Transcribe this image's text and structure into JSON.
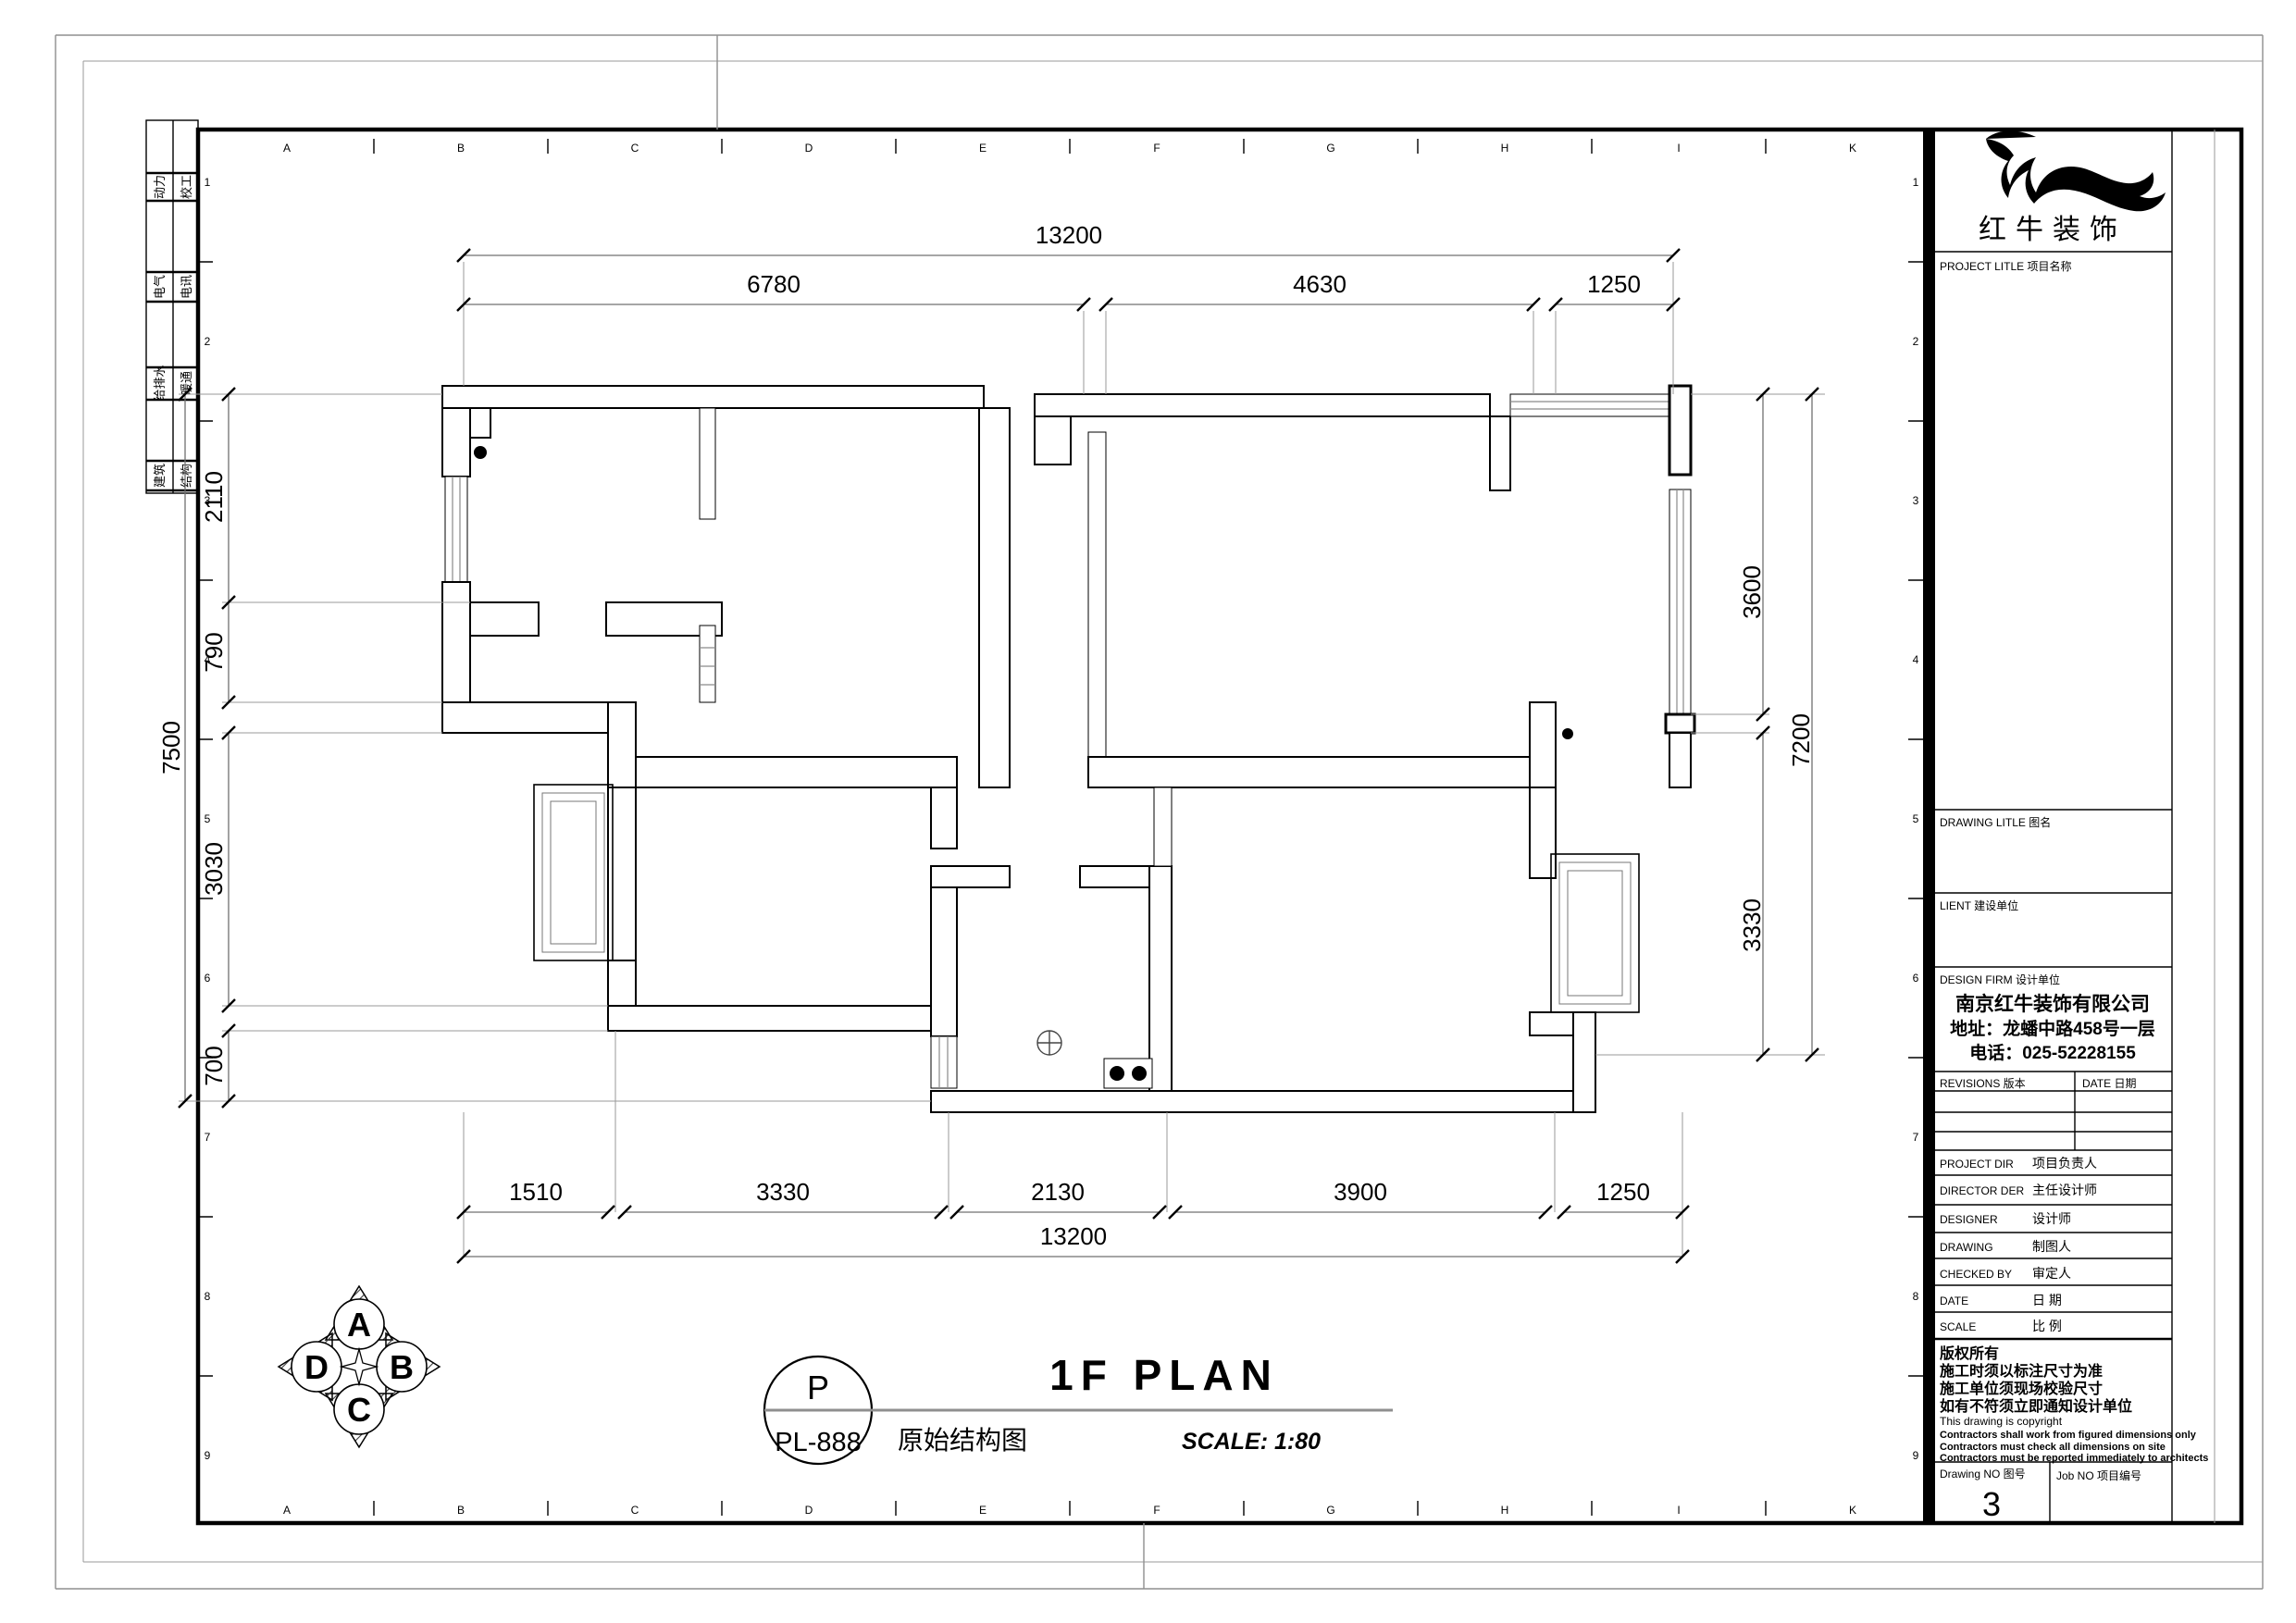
{
  "dims": {
    "top": {
      "total": "13200",
      "segments": [
        "6780",
        "4630",
        "1250"
      ]
    },
    "bottom": {
      "total": "13200",
      "segments": [
        "1510",
        "3330",
        "2130",
        "3900",
        "1250"
      ]
    },
    "left": {
      "total": "7500",
      "segments": [
        "2110",
        "790",
        "3030",
        "700"
      ]
    },
    "right": {
      "total": "7200",
      "segments": [
        "3600",
        "3330"
      ]
    }
  },
  "grid": {
    "columns": [
      "A",
      "B",
      "C",
      "D",
      "E",
      "F",
      "G",
      "H",
      "I",
      "K"
    ],
    "rows": [
      "1",
      "2",
      "3",
      "4",
      "5",
      "6",
      "7",
      "8",
      "9"
    ]
  },
  "stamp_table": {
    "cells": [
      [
        "动力",
        "校工"
      ],
      [
        "电气",
        "电讯"
      ],
      [
        "给排水",
        "暖通"
      ],
      [
        "建筑",
        "结构"
      ]
    ]
  },
  "compass": {
    "top": "A",
    "right": "B",
    "bottom": "C",
    "left": "D"
  },
  "figure": {
    "tag_letter": "P",
    "tag_number": "PL-888",
    "title": "1F PLAN",
    "subtitle": "原始结构图",
    "scale": "SCALE: 1:80"
  },
  "title_block": {
    "logo_text": "红牛装饰",
    "project_title_label": "PROJECT LITLE  项目名称",
    "drawing_title_label": "DRAWING LITLE  图名",
    "client_label": "LIENT  建设单位",
    "design_firm_label": "DESIGN FIRM  设计单位",
    "firm_name": "南京红牛装饰有限公司",
    "firm_address": "地址：龙蟠中路458号一层",
    "firm_phone": "电话：025-52228155",
    "revisions_label": "REVISIONS  版本",
    "date_col_label": "DATE  日期",
    "rows": [
      {
        "en": "PROJECT DIR",
        "zh": "项目负责人"
      },
      {
        "en": "DIRECTOR DER",
        "zh": "主任设计师"
      },
      {
        "en": "DESIGNER",
        "zh": "设计师"
      },
      {
        "en": "DRAWING",
        "zh": "制图人"
      },
      {
        "en": "CHECKED BY",
        "zh": "审定人"
      },
      {
        "en": "DATE",
        "zh": "日  期"
      },
      {
        "en": "SCALE",
        "zh": "比  例"
      }
    ],
    "copyright_lines": [
      "版权所有",
      "施工时须以标注尺寸为准",
      "施工单位须现场校验尺寸",
      "如有不符须立即通知设计单位",
      "This drawing is copyright",
      "Contractors shall work from figured dimensions only",
      "Contractors must check all dimensions on site",
      "Contractors must be reported immediately to architects"
    ],
    "drawing_no_label": "Drawing NO  图号",
    "drawing_no": "3",
    "job_no_label": "Job NO  项目编号"
  }
}
